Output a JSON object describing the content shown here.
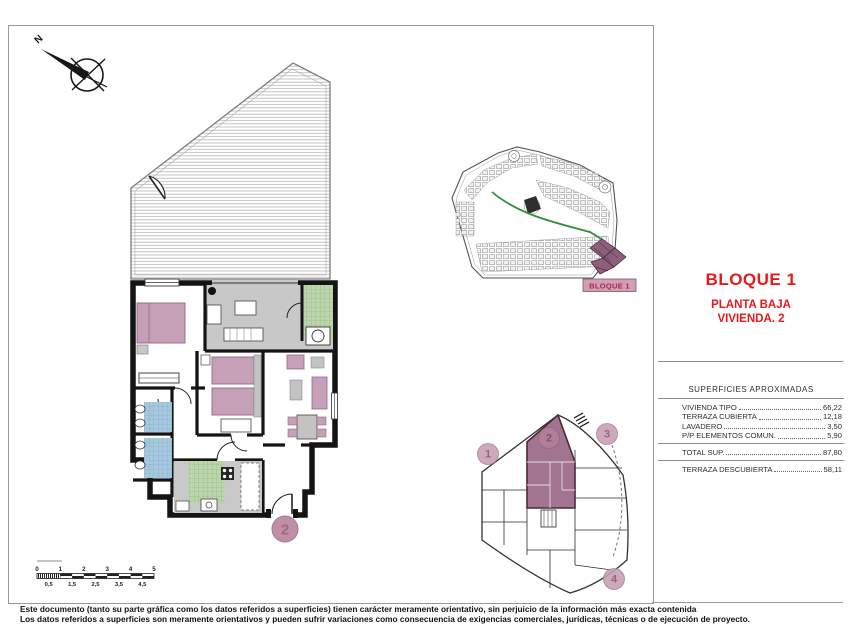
{
  "compass": {
    "north_label": "N"
  },
  "title_block": {
    "block_title": "BLOQUE 1",
    "floor_label": "PLANTA BAJA",
    "unit_label": "VIVIENDA. 2"
  },
  "site_plan": {
    "block_label": "BLOQUE 1"
  },
  "key_plan": {
    "units": [
      "1",
      "2",
      "3",
      "4"
    ],
    "highlighted_unit": "2"
  },
  "floor_plan": {
    "unit_number": "2"
  },
  "surfaces_table": {
    "header": "SUPERFICIES APROXIMADAS",
    "rows": [
      {
        "label": "VIVIENDA TIPO",
        "value": "66,22"
      },
      {
        "label": "TERRAZA CUBIERTA",
        "value": "12,18"
      },
      {
        "label": "LAVADERO",
        "value": "3,50"
      },
      {
        "label": "P/P ELEMENTOS COMUN.",
        "value": "5,90"
      }
    ],
    "total_row": {
      "label": "TOTAL SUP.",
      "value": "87,80"
    },
    "uncovered_row": {
      "label": "TERRAZA DESCUBIERTA",
      "value": "58,11"
    }
  },
  "scale_bar": {
    "major_labels": [
      "0",
      "1",
      "2",
      "3",
      "4",
      "5"
    ],
    "minor_labels": [
      "0,5",
      "1,5",
      "2,5",
      "3,5",
      "4,5"
    ]
  },
  "disclaimer": {
    "line1": "Este documento (tanto su parte gráfica como los datos referidos a superficies) tienen carácter meramente orientativo, sin perjuicio de la información más exacta contenida",
    "line2": "Los datos referidos a superficies son meramente orientativos y pueden sufrir variaciones como consecuencia de exigencias comerciales, jurídicas, técnicas o de ejecución de proyecto."
  },
  "colors": {
    "accent_red": "#e31b1b",
    "highlight_mauve": "#a27490",
    "circle_mauve": "#c18ea7",
    "label_pink": "#d79cb5",
    "tile_green": "#bcd6ab",
    "tile_blue": "#a6c8de",
    "floor_gray": "#c8c8c8",
    "path_green": "#2f8f3a"
  }
}
